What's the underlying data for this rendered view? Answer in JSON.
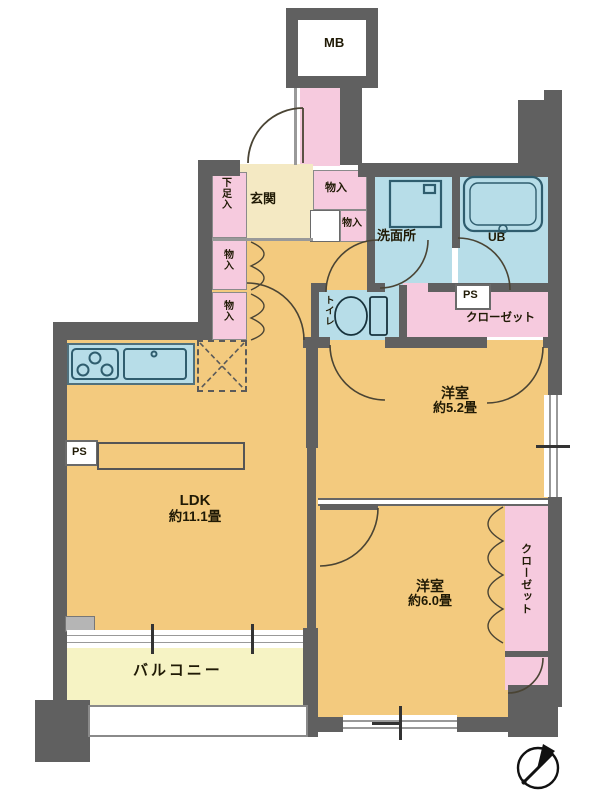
{
  "plan": {
    "mb": "MB",
    "entrance": {
      "genkan": "玄関",
      "shoe_box": "下足入"
    },
    "storages": {
      "s1": "物入",
      "s2": "物入",
      "s3": "物入",
      "s4": "物入"
    },
    "wet": {
      "washroom": "洗面所",
      "bath": "UB",
      "toilet": "トイレ"
    },
    "pipe_spaces": {
      "ps_left": "PS",
      "ps_right": "PS"
    },
    "closets": {
      "upper": "クローゼット",
      "side": "クローゼット"
    },
    "rooms": {
      "ldk": {
        "name": "LDK",
        "size": "約11.1畳"
      },
      "western1": {
        "name": "洋室",
        "size": "約5.2畳"
      },
      "western2": {
        "name": "洋室",
        "size": "約6.0畳"
      }
    },
    "balcony": "バルコニー"
  },
  "colors": {
    "wall": "#606060",
    "room_orange": "#f3ca7e",
    "entry_cream": "#f4e9c3",
    "balcony_yellow": "#f6f3c4",
    "wet_blue": "#b7dde8",
    "closet_pink": "#f6cade",
    "fixture_stroke": "#2f5d6e",
    "door_arc": "#4a4434"
  }
}
